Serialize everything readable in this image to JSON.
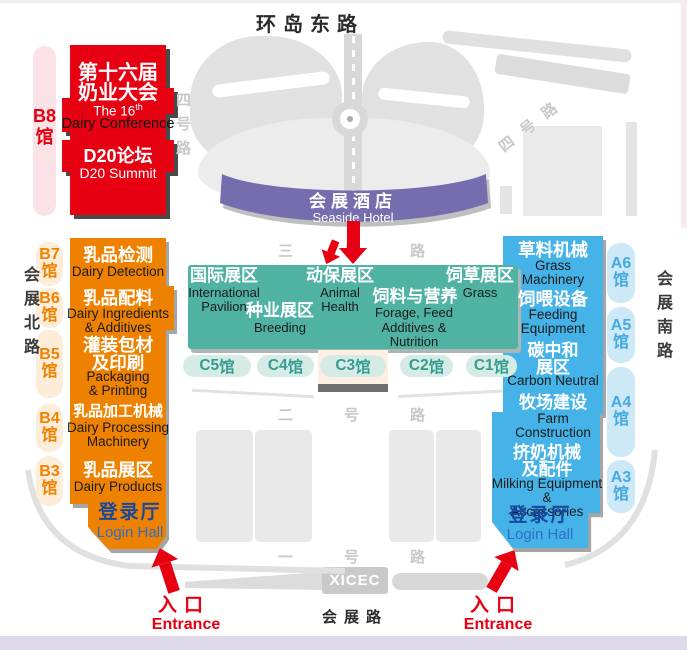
{
  "colors": {
    "red": "#e60012",
    "orange": "#ee8200",
    "teal": "#4fb2a3",
    "blue": "#45b3e8",
    "purple": "#756dae",
    "login_blue": "#17489e",
    "entrance_red": "#e60012"
  },
  "roads": {
    "north": "环岛东路",
    "no4_left": "四号路",
    "no4_right": "四号路",
    "no3": "三号路",
    "no2": "二号路",
    "no1": "一号路",
    "west": "会展北路",
    "east": "会展南路",
    "south": "会展路",
    "venue_code": "XICEC"
  },
  "conference_block": {
    "title_zh_line1": "第十六届",
    "title_zh_line2": "奶业大会",
    "title_en_prefix": "The 16",
    "title_en_sup": "th",
    "title_en_line2": "Dairy Conference",
    "summit_zh": "D20论坛",
    "summit_en": "D20 Summit"
  },
  "hotel": {
    "zh": "会展酒店",
    "en": "Seaside Hotel"
  },
  "halls": {
    "b8": {
      "id": "B8",
      "suffix": "馆"
    },
    "b7": {
      "id": "B7",
      "suffix": "馆"
    },
    "b6": {
      "id": "B6",
      "suffix": "馆"
    },
    "b5": {
      "id": "B5",
      "suffix": "馆"
    },
    "b4": {
      "id": "B4",
      "suffix": "馆"
    },
    "b3": {
      "id": "B3",
      "suffix": "馆"
    },
    "a6": {
      "id": "A6",
      "suffix": "馆"
    },
    "a5": {
      "id": "A5",
      "suffix": "馆"
    },
    "a4": {
      "id": "A4",
      "suffix": "馆"
    },
    "a3": {
      "id": "A3",
      "suffix": "馆"
    },
    "c5": {
      "id": "C5",
      "suffix": "馆"
    },
    "c4": {
      "id": "C4",
      "suffix": "馆"
    },
    "c3": {
      "id": "C3",
      "suffix": "馆"
    },
    "c2": {
      "id": "C2",
      "suffix": "馆"
    },
    "c1": {
      "id": "C1",
      "suffix": "馆"
    }
  },
  "west_zone": {
    "sections": [
      {
        "zh": "乳品检测",
        "en": "Dairy Detection"
      },
      {
        "zh": "乳品配料",
        "en": "Dairy Ingredients\n& Additives"
      },
      {
        "zh": "灌装包材\n及印刷",
        "en": "Packaging\n& Printing"
      },
      {
        "zh": "乳品加工机械",
        "en": "Dairy Processing\nMachinery"
      },
      {
        "zh": "乳品展区",
        "en": "Dairy Products"
      }
    ],
    "login": {
      "zh": "登录厅",
      "en": "Login Hall"
    }
  },
  "east_zone": {
    "sections": [
      {
        "zh": "草料机械",
        "en": "Grass\nMachinery"
      },
      {
        "zh": "饲喂设备",
        "en": "Feeding\nEquipment"
      },
      {
        "zh": "碳中和\n展区",
        "en": "Carbon Neutral"
      },
      {
        "zh": "牧场建设",
        "en": "Farm\nConstruction"
      },
      {
        "zh": "挤奶机械\n及配件",
        "en": "Milking Equipment &\nAccessories"
      }
    ],
    "login": {
      "zh": "登录厅",
      "en": "Login Hall"
    }
  },
  "center_zone": {
    "zones": [
      {
        "zh": "国际展区",
        "en": "International\nPavilion"
      },
      {
        "zh": "动保展区",
        "en": "Animal\nHealth"
      },
      {
        "zh": "饲草展区",
        "en": "Grass"
      },
      {
        "zh": "种业展区",
        "en": "Breeding"
      },
      {
        "zh": "饲料与营养",
        "en": "Forage, Feed\nAdditives &\nNutrition"
      }
    ]
  },
  "entrances": {
    "left": {
      "zh": "入口",
      "en": "Entrance"
    },
    "right": {
      "zh": "入口",
      "en": "Entrance"
    }
  }
}
